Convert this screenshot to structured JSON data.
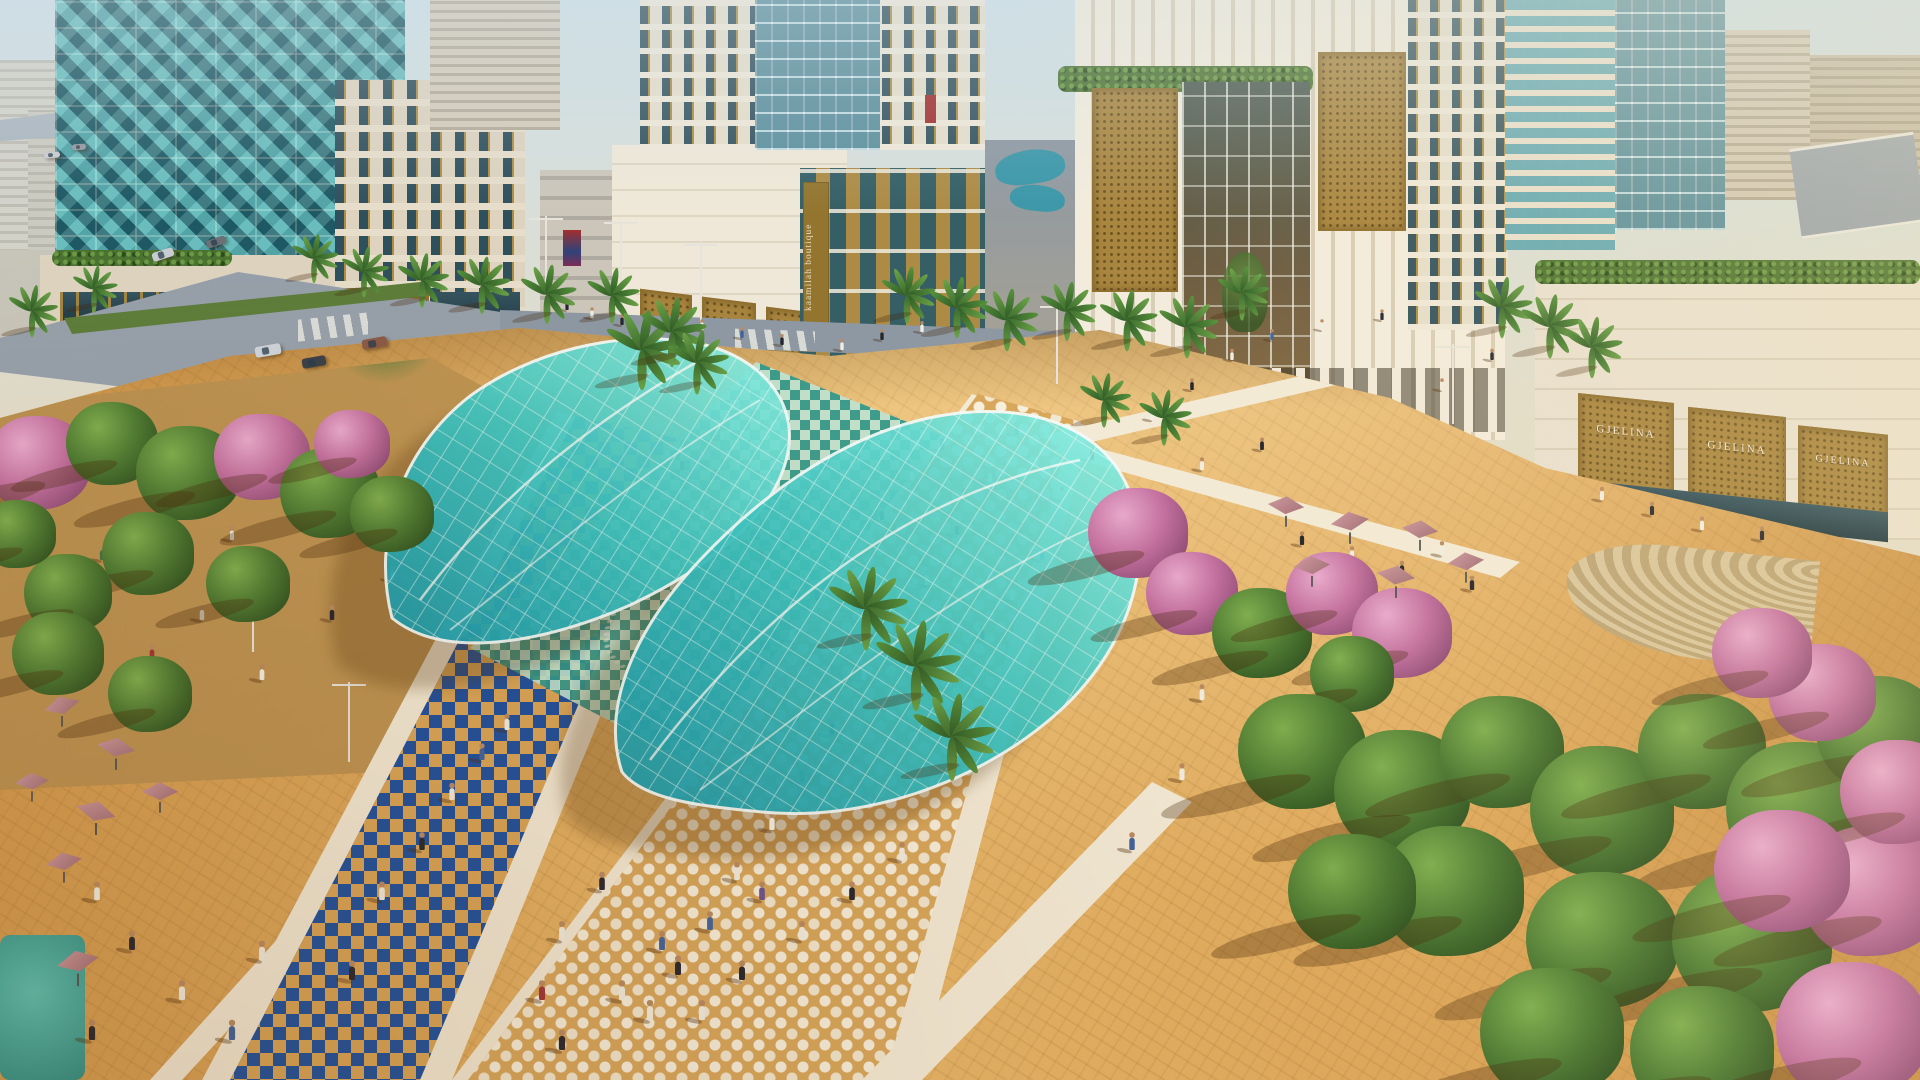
{
  "scene": {
    "title": "Aerial rendering of a downtown retail plaza",
    "description": "Sunlit architectural visualization of a pedestrian plaza between cream-and-gold towers. Two organic turquoise glass canopies shade golden paving crossed by cobalt-blue and white mosaic promenades. Crowds walk among palms, flowering pink trees and cafe umbrellas; roads with cars pass on the upper left and a hazy low-rise city fills the horizon.",
    "time_of_day": "late afternoon, long shadows, sun from upper right"
  },
  "signage": {
    "saphir_label": "SAPHIR",
    "saphir_count": 3,
    "gjelina_label": "GJELINA",
    "gjelina_count": 3,
    "kaamilah_label": "kaamilah boutique",
    "kaamilah_orientation": "vertical"
  },
  "palette": {
    "sky": "#cfe0e6",
    "sand_light": "#eaba6c",
    "sand": "#d9a558",
    "canopy_teal_light": "#8ff0e2",
    "canopy_teal_deep": "#149aae",
    "mosaic_blue": "#1d4f9e",
    "mosaic_teal": "#2f9a8e",
    "mosaic_white": "#f3ead6",
    "building_cream": "#ece3d1",
    "gold": "#a8853e",
    "glass_teal": "#2a6b77",
    "tree_green": "#4f7c33",
    "blossom_pink": "#c4719f",
    "umbrella_pink": "#bb8289",
    "street_grey": "#96a0aa",
    "person_colors": [
      "#f1ede2",
      "#26262e",
      "#41639c",
      "#9e3636",
      "#41704a",
      "#6d5390",
      "#c99f68",
      "#c06b84"
    ]
  },
  "elements": {
    "palms": [
      [
        312,
        278,
        0.7
      ],
      [
        362,
        292,
        0.72
      ],
      [
        420,
        302,
        0.78
      ],
      [
        480,
        308,
        0.82
      ],
      [
        545,
        318,
        0.85
      ],
      [
        610,
        318,
        0.8
      ],
      [
        905,
        318,
        0.82
      ],
      [
        955,
        332,
        0.88
      ],
      [
        1005,
        345,
        0.9
      ],
      [
        1065,
        335,
        0.85
      ],
      [
        1125,
        345,
        0.88
      ],
      [
        1185,
        352,
        0.9
      ],
      [
        1240,
        315,
        0.78
      ],
      [
        640,
        382,
        1.15
      ],
      [
        670,
        360,
        1.0
      ],
      [
        695,
        388,
        0.92
      ],
      [
        864,
        642,
        1.2
      ],
      [
        914,
        702,
        1.3
      ],
      [
        950,
        772,
        1.25
      ],
      [
        1500,
        332,
        0.88
      ],
      [
        1548,
        352,
        0.92
      ],
      [
        1590,
        372,
        0.88
      ],
      [
        1102,
        422,
        0.78
      ],
      [
        1162,
        440,
        0.8
      ],
      [
        30,
        332,
        0.75
      ],
      [
        92,
        308,
        0.68
      ]
    ],
    "trees": [
      [
        38,
        468,
        52,
        1
      ],
      [
        112,
        448,
        46,
        0
      ],
      [
        188,
        478,
        52,
        0
      ],
      [
        262,
        462,
        48,
        1
      ],
      [
        330,
        498,
        50,
        0
      ],
      [
        392,
        518,
        42,
        0
      ],
      [
        148,
        558,
        46,
        0
      ],
      [
        68,
        598,
        44,
        0
      ],
      [
        248,
        588,
        42,
        0
      ],
      [
        18,
        538,
        38,
        0
      ],
      [
        352,
        448,
        38,
        1
      ],
      [
        58,
        658,
        46,
        0
      ],
      [
        150,
        698,
        42,
        0
      ],
      [
        1138,
        538,
        50,
        1
      ],
      [
        1192,
        598,
        46,
        1
      ],
      [
        1262,
        638,
        50,
        0
      ],
      [
        1332,
        598,
        46,
        1
      ],
      [
        1402,
        638,
        50,
        1
      ],
      [
        1352,
        678,
        42,
        0
      ],
      [
        1302,
        758,
        64,
        0
      ],
      [
        1402,
        798,
        68,
        0
      ],
      [
        1502,
        758,
        62,
        0
      ],
      [
        1602,
        818,
        72,
        0
      ],
      [
        1702,
        758,
        64,
        0
      ],
      [
        1802,
        818,
        76,
        0
      ],
      [
        1878,
        738,
        62,
        0
      ],
      [
        1452,
        898,
        72,
        0
      ],
      [
        1602,
        948,
        76,
        0
      ],
      [
        1752,
        948,
        80,
        0
      ],
      [
        1872,
        898,
        72,
        1
      ],
      [
        1822,
        698,
        54,
        1
      ],
      [
        1762,
        658,
        50,
        1
      ],
      [
        1898,
        798,
        58,
        1
      ],
      [
        1352,
        898,
        64,
        0
      ],
      [
        1552,
        1040,
        72,
        0
      ],
      [
        1702,
        1058,
        72,
        0
      ],
      [
        1852,
        1038,
        76,
        1
      ],
      [
        1782,
        878,
        68,
        1
      ]
    ],
    "umbrellas": [
      [
        62,
        706,
        0.9,
        -15
      ],
      [
        116,
        748,
        0.95,
        10
      ],
      [
        32,
        782,
        0.85,
        -5
      ],
      [
        96,
        812,
        1.0,
        15
      ],
      [
        160,
        792,
        0.9,
        0
      ],
      [
        64,
        862,
        0.9,
        -10
      ],
      [
        78,
        962,
        1.05,
        -12
      ],
      [
        1286,
        506,
        0.9,
        5
      ],
      [
        1350,
        522,
        0.95,
        -8
      ],
      [
        1420,
        530,
        0.9,
        6
      ],
      [
        1312,
        566,
        0.9,
        -4
      ],
      [
        1396,
        576,
        0.95,
        8
      ],
      [
        1466,
        562,
        0.9,
        -6
      ]
    ],
    "cars": [
      [
        255,
        345,
        26,
        11,
        "#ccd3d9",
        -10
      ],
      [
        302,
        357,
        24,
        10,
        "#3a4148",
        -10
      ],
      [
        362,
        338,
        25,
        10,
        "#8a5a46",
        -10
      ],
      [
        152,
        250,
        22,
        9,
        "#c8cdd2",
        -18
      ],
      [
        206,
        238,
        20,
        8,
        "#6b7077",
        -18
      ],
      [
        44,
        152,
        16,
        6,
        "#c9ccd0",
        -4
      ],
      [
        72,
        144,
        14,
        6,
        "#94989e",
        -4
      ]
    ],
    "lamps": [
      [
        620,
        300
      ],
      [
        700,
        322
      ],
      [
        348,
        762
      ],
      [
        252,
        652
      ],
      [
        1056,
        384
      ],
      [
        1452,
        424
      ],
      [
        545,
        296
      ]
    ],
    "people": [
      [
        648,
        1020,
        0
      ],
      [
        676,
        975,
        1
      ],
      [
        708,
        930,
        2
      ],
      [
        735,
        880,
        0
      ],
      [
        540,
        1000,
        3
      ],
      [
        560,
        940,
        0
      ],
      [
        600,
        890,
        1
      ],
      [
        770,
        830,
        0
      ],
      [
        800,
        782,
        4
      ],
      [
        830,
        735,
        1
      ],
      [
        862,
        680,
        0
      ],
      [
        893,
        633,
        2
      ],
      [
        925,
        585,
        0
      ],
      [
        955,
        535,
        1
      ],
      [
        988,
        482,
        0
      ],
      [
        1015,
        435,
        2
      ],
      [
        760,
        900,
        5
      ],
      [
        700,
        800,
        6
      ],
      [
        790,
        640,
        0
      ],
      [
        815,
        600,
        1
      ],
      [
        845,
        560,
        0
      ],
      [
        760,
        560,
        3
      ],
      [
        735,
        600,
        0
      ],
      [
        880,
        520,
        1
      ],
      [
        910,
        480,
        0
      ],
      [
        940,
        450,
        2
      ],
      [
        700,
        520,
        0
      ],
      [
        680,
        470,
        1
      ],
      [
        720,
        440,
        0
      ],
      [
        980,
        640,
        1
      ],
      [
        1010,
        600,
        0
      ],
      [
        1040,
        560,
        2
      ],
      [
        1060,
        500,
        0
      ],
      [
        1090,
        460,
        1
      ],
      [
        565,
        310,
        1
      ],
      [
        590,
        318,
        0
      ],
      [
        620,
        325,
        1
      ],
      [
        700,
        330,
        0
      ],
      [
        740,
        338,
        2
      ],
      [
        780,
        345,
        1
      ],
      [
        840,
        350,
        0
      ],
      [
        880,
        340,
        1
      ],
      [
        920,
        332,
        0
      ],
      [
        1150,
        420,
        0
      ],
      [
        1190,
        390,
        1
      ],
      [
        1230,
        360,
        0
      ],
      [
        1270,
        340,
        2
      ],
      [
        1320,
        330,
        0
      ],
      [
        1380,
        320,
        1
      ],
      [
        1200,
        470,
        0
      ],
      [
        1260,
        450,
        1
      ],
      [
        1440,
        390,
        0
      ],
      [
        1490,
        360,
        1
      ],
      [
        120,
        470,
        0
      ],
      [
        170,
        500,
        1
      ],
      [
        230,
        540,
        0
      ],
      [
        300,
        500,
        2
      ],
      [
        350,
        470,
        1
      ],
      [
        200,
        620,
        0
      ],
      [
        150,
        660,
        3
      ],
      [
        260,
        680,
        0
      ],
      [
        330,
        620,
        1
      ],
      [
        390,
        580,
        0
      ],
      [
        100,
        560,
        4
      ],
      [
        95,
        900,
        0
      ],
      [
        130,
        950,
        1
      ],
      [
        180,
        1000,
        0
      ],
      [
        230,
        1040,
        2
      ],
      [
        90,
        1040,
        1
      ],
      [
        260,
        960,
        0
      ],
      [
        380,
        900,
        0
      ],
      [
        420,
        850,
        1
      ],
      [
        450,
        800,
        0
      ],
      [
        480,
        760,
        2
      ],
      [
        350,
        980,
        1
      ],
      [
        505,
        730,
        0
      ],
      [
        1300,
        545,
        1
      ],
      [
        1350,
        560,
        0
      ],
      [
        1400,
        575,
        1
      ],
      [
        1440,
        555,
        0
      ],
      [
        1470,
        590,
        1
      ],
      [
        560,
        1050,
        1
      ],
      [
        620,
        1000,
        0
      ],
      [
        660,
        950,
        2
      ],
      [
        700,
        1020,
        0
      ],
      [
        740,
        980,
        1
      ],
      [
        800,
        940,
        0
      ],
      [
        850,
        900,
        1
      ],
      [
        900,
        860,
        0
      ],
      [
        1200,
        700,
        0
      ],
      [
        1250,
        740,
        1
      ],
      [
        1180,
        780,
        0
      ],
      [
        1130,
        850,
        2
      ],
      [
        1600,
        500,
        0
      ],
      [
        1650,
        515,
        1
      ],
      [
        1700,
        530,
        0
      ],
      [
        1760,
        540,
        1
      ]
    ]
  }
}
